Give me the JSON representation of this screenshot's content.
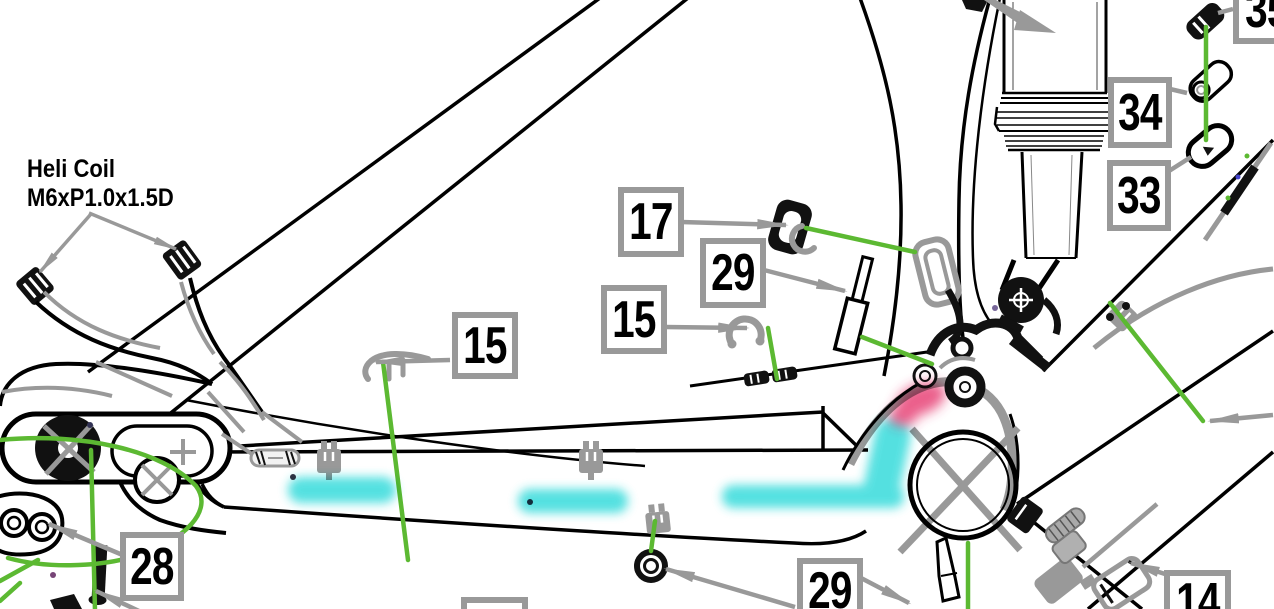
{
  "diagram": {
    "annotation": {
      "line1": "Heli Coil",
      "line2": "M6xP1.0x1.5D"
    },
    "callouts": {
      "c17": "17",
      "c29_top": "29",
      "c15_mid": "15",
      "c15_left": "15",
      "c34": "34",
      "c33": "33",
      "c35": "35",
      "c28": "28",
      "c29_bottom": "29",
      "c14": "14"
    },
    "colors": {
      "line_art": "#000000",
      "detail_gray": "#999999",
      "callout_border": "#999999",
      "routing_green": "#5cb932",
      "highlight_cyan": "#2bd9d9",
      "highlight_red": "#e5336b"
    }
  }
}
